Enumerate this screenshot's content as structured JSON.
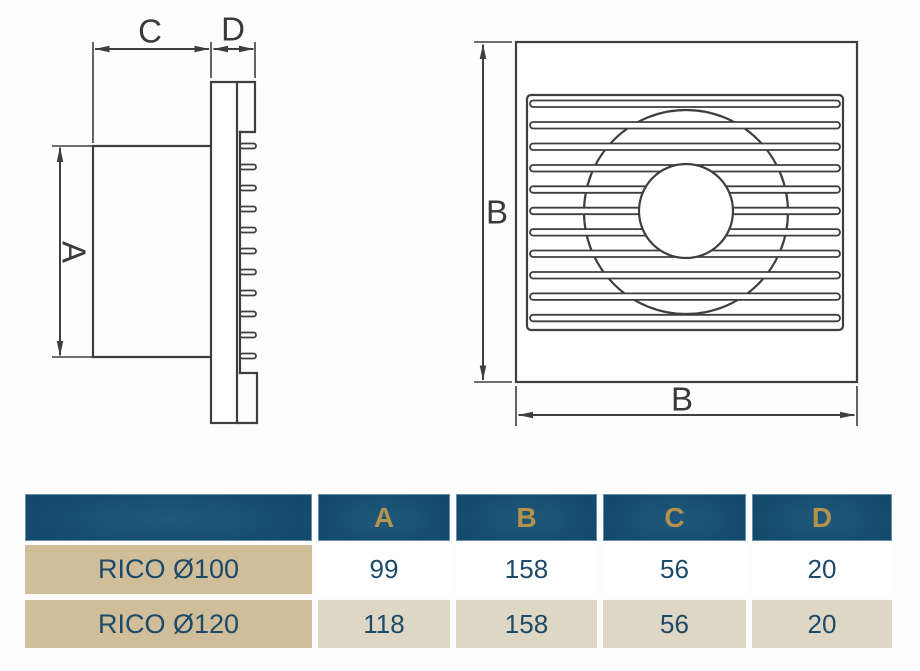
{
  "diagram": {
    "labels": {
      "a": "A",
      "b": "B",
      "c": "C",
      "d": "D"
    }
  },
  "table": {
    "columns": [
      "A",
      "B",
      "C",
      "D"
    ],
    "rows": [
      {
        "model": "RICO Ø100",
        "values": [
          "99",
          "158",
          "56",
          "20"
        ]
      },
      {
        "model": "RICO Ø120",
        "values": [
          "118",
          "158",
          "56",
          "20"
        ]
      }
    ]
  },
  "colors": {
    "line": "#3e3e3e",
    "header_navy_dark": "#0d3a56",
    "header_navy_light": "#1e587b",
    "gold": "#b5924b",
    "tan": "#cfbe99",
    "beige": "#ded7c5",
    "navy_text": "#1d4a68"
  }
}
